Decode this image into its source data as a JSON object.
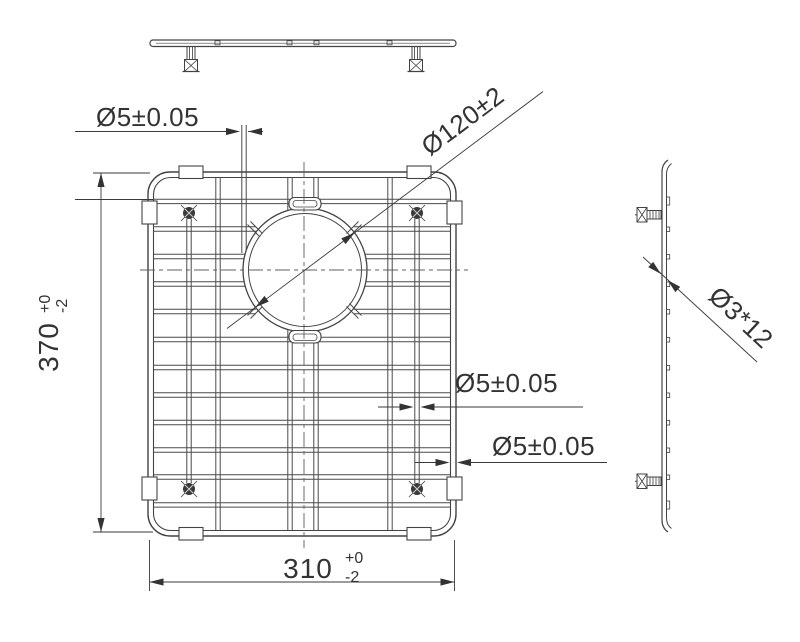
{
  "drawing": {
    "background": "#ffffff",
    "line_color": "#434343",
    "dim_color": "#333333",
    "dimensions": {
      "top_wire_dia": "Ø5±0.05",
      "circle_dia": "Ø120±2",
      "height": {
        "value": "370",
        "upper": "+0",
        "lower": "-2"
      },
      "mid_wire_dia": "Ø5±0.05",
      "rim_wire_dia": "Ø5±0.05",
      "width": {
        "value": "310",
        "upper": "+0",
        "lower": "-2"
      },
      "foot_size": "Ø3*12"
    }
  }
}
